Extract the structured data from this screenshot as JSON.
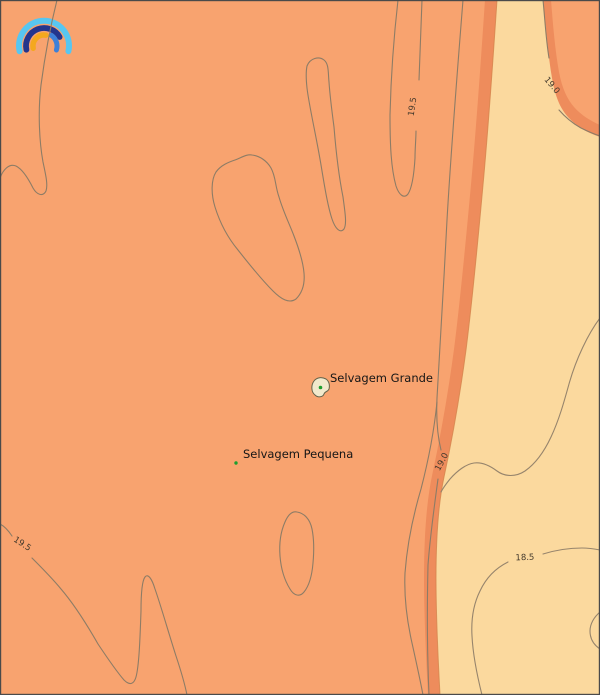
{
  "map": {
    "description": "Filled contour map around the Selvagens Islands",
    "islands": [
      {
        "name": "Selvagem Grande",
        "marker": "green-dot-with-islet-outline"
      },
      {
        "name": "Selvagem Pequena",
        "marker": "green-dot"
      }
    ],
    "contour_labels": [
      {
        "text": "19.5",
        "location": "upper-right-hairpin"
      },
      {
        "text": "19.0",
        "location": "top-right-corner-lobe"
      },
      {
        "text": "19.0",
        "location": "mid-right-boundary"
      },
      {
        "text": "19.5",
        "location": "bottom-left"
      },
      {
        "text": "18.5",
        "location": "bottom-right"
      }
    ],
    "colors": {
      "warm_fill": "#F8A36F",
      "boundary_band_fill": "#EE8C5C",
      "cool_fill": "#FBD99E",
      "contour_line": "#8D7C66",
      "island_fill": "#F1E9CC",
      "island_marker_green": "#1E9E2E",
      "logo_light_blue": "#58C6F0",
      "logo_navy": "#24358C",
      "logo_mid_blue": "#3E80D8",
      "logo_orange": "#F4A81E",
      "border": "#4a4a4a"
    },
    "logo": "rainbow-arcs-logo"
  },
  "chart_data": {
    "type": "contour",
    "contour_levels": [
      18.5,
      19.0,
      19.5
    ],
    "contour_label_texts": [
      "19.5",
      "19.0",
      "19.0",
      "19.5",
      "18.5"
    ],
    "filled_regions": [
      {
        "side": "left-and-top-right-corner",
        "color": "#F8A36F"
      },
      {
        "side": "narrow-band-along-19.0-boundary",
        "color": "#EE8C5C"
      },
      {
        "side": "right",
        "color": "#FBD99E"
      }
    ],
    "points_of_interest": [
      "Selvagem Grande",
      "Selvagem Pequena"
    ]
  }
}
